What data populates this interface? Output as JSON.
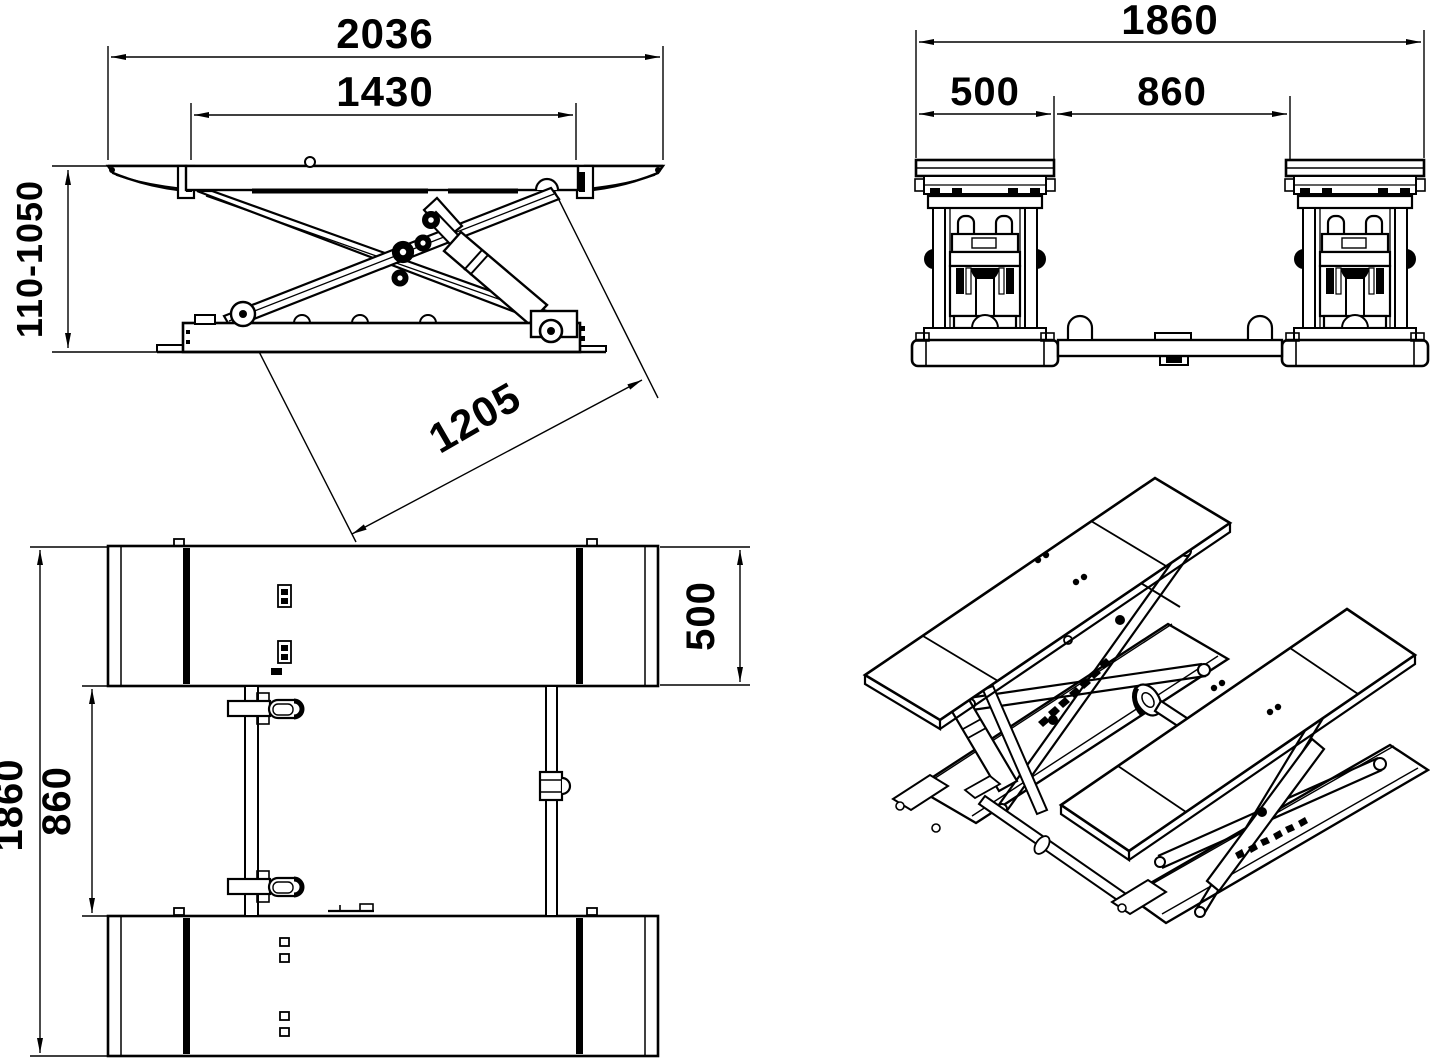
{
  "page": {
    "kind": "technical line drawing",
    "subject": "scissor lift dimensional drawing",
    "ink": "#000000",
    "paper": "#ffffff"
  },
  "views": {
    "side": {
      "label": "side elevation view",
      "overall_length": "2036",
      "platform_length": "1430",
      "height_range": "110-1050",
      "arm_length": "1205"
    },
    "front": {
      "label": "front elevation view",
      "overall_width": "1860",
      "platform_width": "500",
      "inner_track": "860"
    },
    "plan": {
      "label": "plan view",
      "overall_width": "1860",
      "inner_track": "860",
      "platform_width": "500"
    },
    "isometric": {
      "label": "isometric view"
    }
  }
}
